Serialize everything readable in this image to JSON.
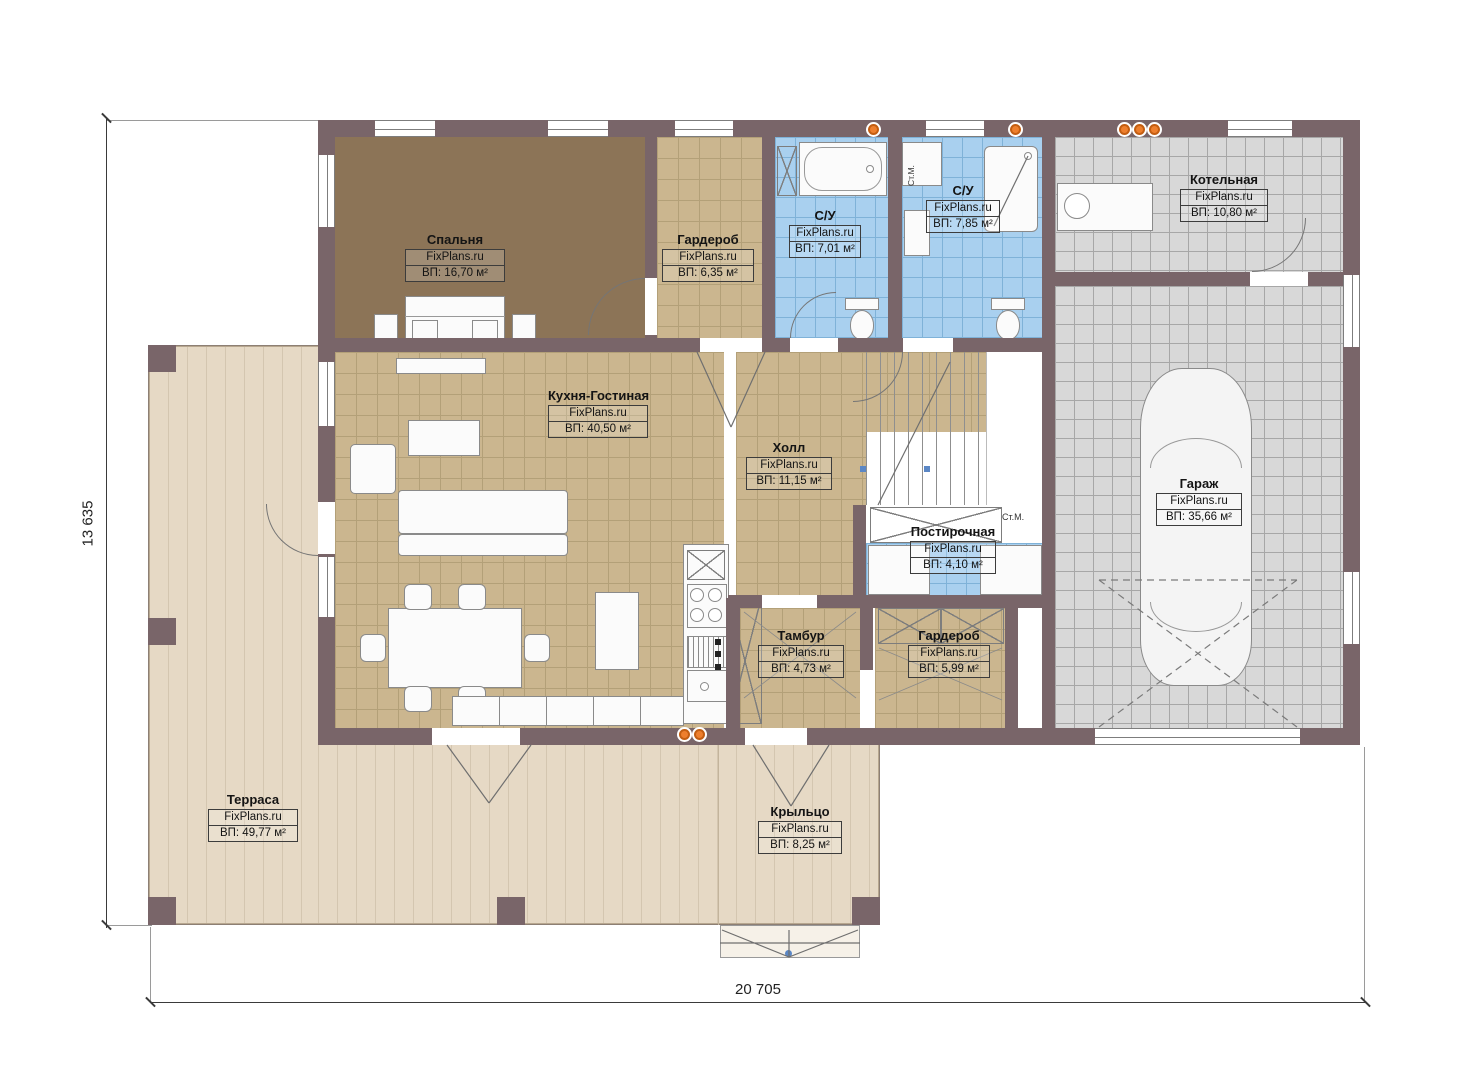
{
  "plan": {
    "brand": "FixPlans.ru",
    "dim_width": "20 705",
    "dim_height": "13 635",
    "rooms": [
      {
        "name": "Спальня",
        "area": "ВП: 16,70 м²"
      },
      {
        "name": "Гардероб",
        "area": "ВП: 6,35 м²"
      },
      {
        "name": "С/У",
        "area": "ВП: 7,01 м²"
      },
      {
        "name": "С/У",
        "area": "ВП: 7,85 м²"
      },
      {
        "name": "Котельная",
        "area": "ВП: 10,80 м²"
      },
      {
        "name": "Кухня-Гостиная",
        "area": "ВП: 40,50 м²"
      },
      {
        "name": "Холл",
        "area": "ВП: 11,15 м²"
      },
      {
        "name": "Гараж",
        "area": "ВП: 35,66 м²"
      },
      {
        "name": "Постирочная",
        "area": "ВП: 4,10 м²"
      },
      {
        "name": "Тамбур",
        "area": "ВП: 4,73 м²"
      },
      {
        "name": "Гардероб",
        "area": "ВП: 5,99 м²"
      },
      {
        "name": "Терраса",
        "area": "ВП: 49,77 м²"
      },
      {
        "name": "Крыльцо",
        "area": "ВП: 8,25 м²"
      }
    ],
    "annotations": {
      "washing_machine_bath": "Ст.М.",
      "washing_machine_laundry": "Ст.М."
    },
    "colors": {
      "wall": "#796569",
      "tile_tan": "#cbb68f",
      "tile_blue": "#a9d0ef",
      "tile_grey": "#d8d8d8",
      "floor_bedroom": "#8c7457",
      "terrace": "#e6d9c5",
      "accent_orange": "#ee7f2d"
    }
  }
}
